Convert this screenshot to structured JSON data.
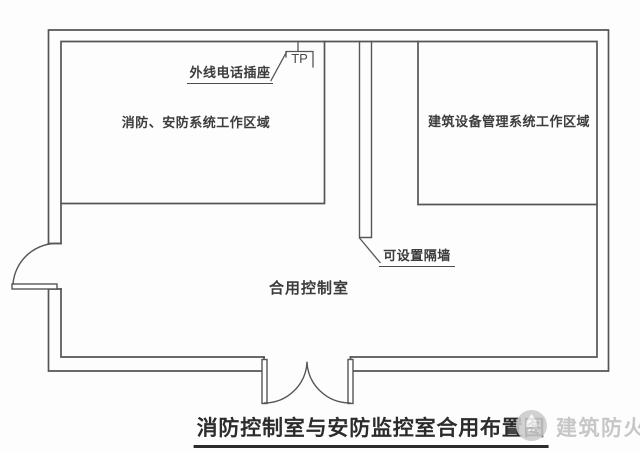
{
  "rooms": {
    "left_area_label": "消防、安防系统工作区域",
    "right_area_label": "建筑设备管理系统工作区域",
    "combined_room_label": "合用控制室"
  },
  "annotations": {
    "tp_symbol": "TP",
    "telephone_socket_label": "外线电话插座",
    "partition_label": "可设置隔墙"
  },
  "title": "消防控制室与安防监控室合用布置图",
  "watermark": {
    "text": "建筑防火",
    "logo_icon": "fire-protection-logo"
  },
  "colors": {
    "wall_line": "#565656",
    "title_text": "#2c2c2c",
    "watermark_gray": "#c7c7c7",
    "background": "#fdfdfd"
  }
}
